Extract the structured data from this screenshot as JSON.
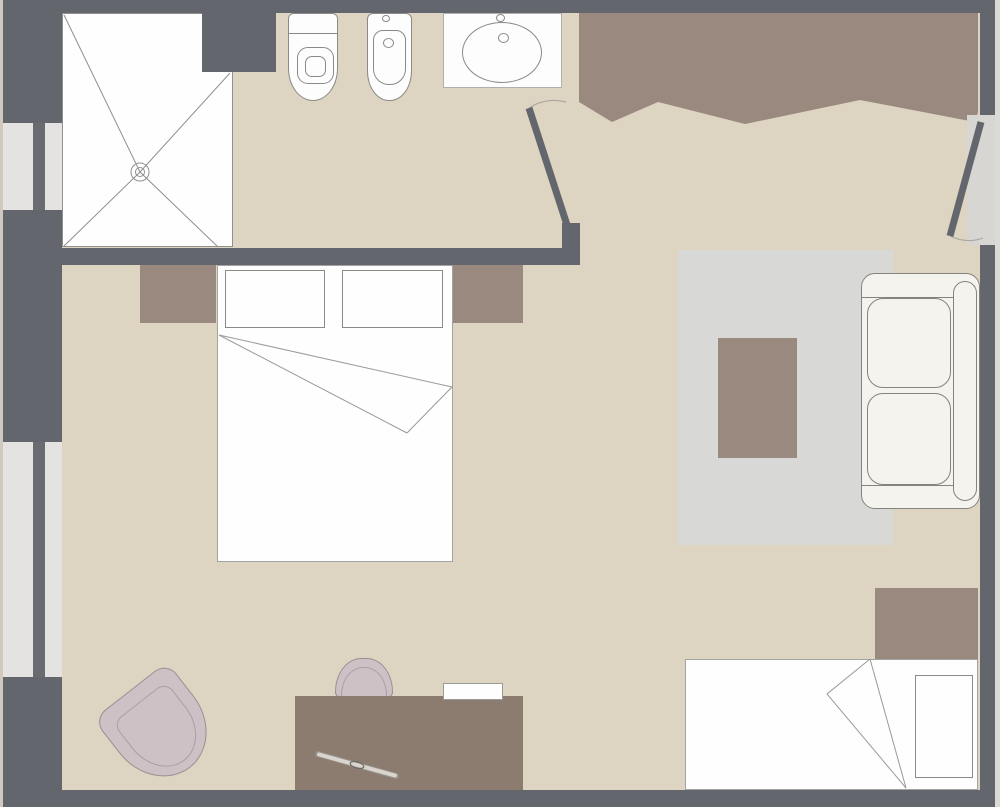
{
  "meta": {
    "kind": "architectural floor plan, top-down view, no visible text",
    "canvas": {
      "width": 1000,
      "height": 807
    }
  },
  "palette": {
    "wall": "#63666c",
    "floor": "#ddd4c1",
    "outside_left": "#cfc9be",
    "outside_right": "#dcdad6",
    "window_frame": "#e4e3e1",
    "window_glass": "#686b70",
    "wood_brown": "#9a897e",
    "desk_brown": "#8c7c70",
    "rug_gray": "#d8d8d6",
    "fixture_white": "#fdfdfd",
    "sofa_white": "#f4f3ed",
    "upholstery_mauve": "#cdc1c5",
    "outline_gray": "#8a8a88",
    "doorway_recess": "#d8d6d3"
  },
  "rooms": [
    {
      "name": "bathroom",
      "position": "top-left",
      "contents": [
        "shower",
        "toilet",
        "bidet",
        "sink"
      ]
    },
    {
      "name": "entry-hall",
      "position": "top-right",
      "contents": [
        "wardrobe",
        "entrance-door"
      ]
    },
    {
      "name": "bedroom-living-room",
      "position": "center",
      "contents": [
        "double-bed",
        "nightstands",
        "rug",
        "coffee-table",
        "sofa",
        "desk",
        "desk-chair",
        "armchair",
        "single-bed"
      ]
    }
  ],
  "elements": {
    "doors": [
      {
        "name": "entrance-door",
        "wall": "right",
        "swing": "inward"
      },
      {
        "name": "bathroom-door",
        "wall": "between hall and bathroom",
        "swing": "inward"
      }
    ],
    "windows": [
      {
        "name": "window-upper",
        "wall": "left"
      },
      {
        "name": "window-lower",
        "wall": "left"
      }
    ],
    "furniture": [
      {
        "name": "shower-tray",
        "detail": "square tray with X fold lines and center drain"
      },
      {
        "name": "toilet"
      },
      {
        "name": "bidet"
      },
      {
        "name": "sink-with-counter"
      },
      {
        "name": "wardrobe",
        "detail": "built-in closet with zig-zag front edge"
      },
      {
        "name": "double-bed",
        "detail": "two pillows, folded blanket corner"
      },
      {
        "name": "nightstand-left"
      },
      {
        "name": "nightstand-right"
      },
      {
        "name": "rug"
      },
      {
        "name": "coffee-table"
      },
      {
        "name": "sofa",
        "detail": "two-seat, against right wall"
      },
      {
        "name": "desk",
        "detail": "with paper sheet and pen on top"
      },
      {
        "name": "desk-chair"
      },
      {
        "name": "armchair",
        "detail": "rotated, bottom-left corner"
      },
      {
        "name": "single-bed",
        "detail": "one pillow, folded blanket"
      },
      {
        "name": "nightstand-single-bed"
      }
    ]
  }
}
